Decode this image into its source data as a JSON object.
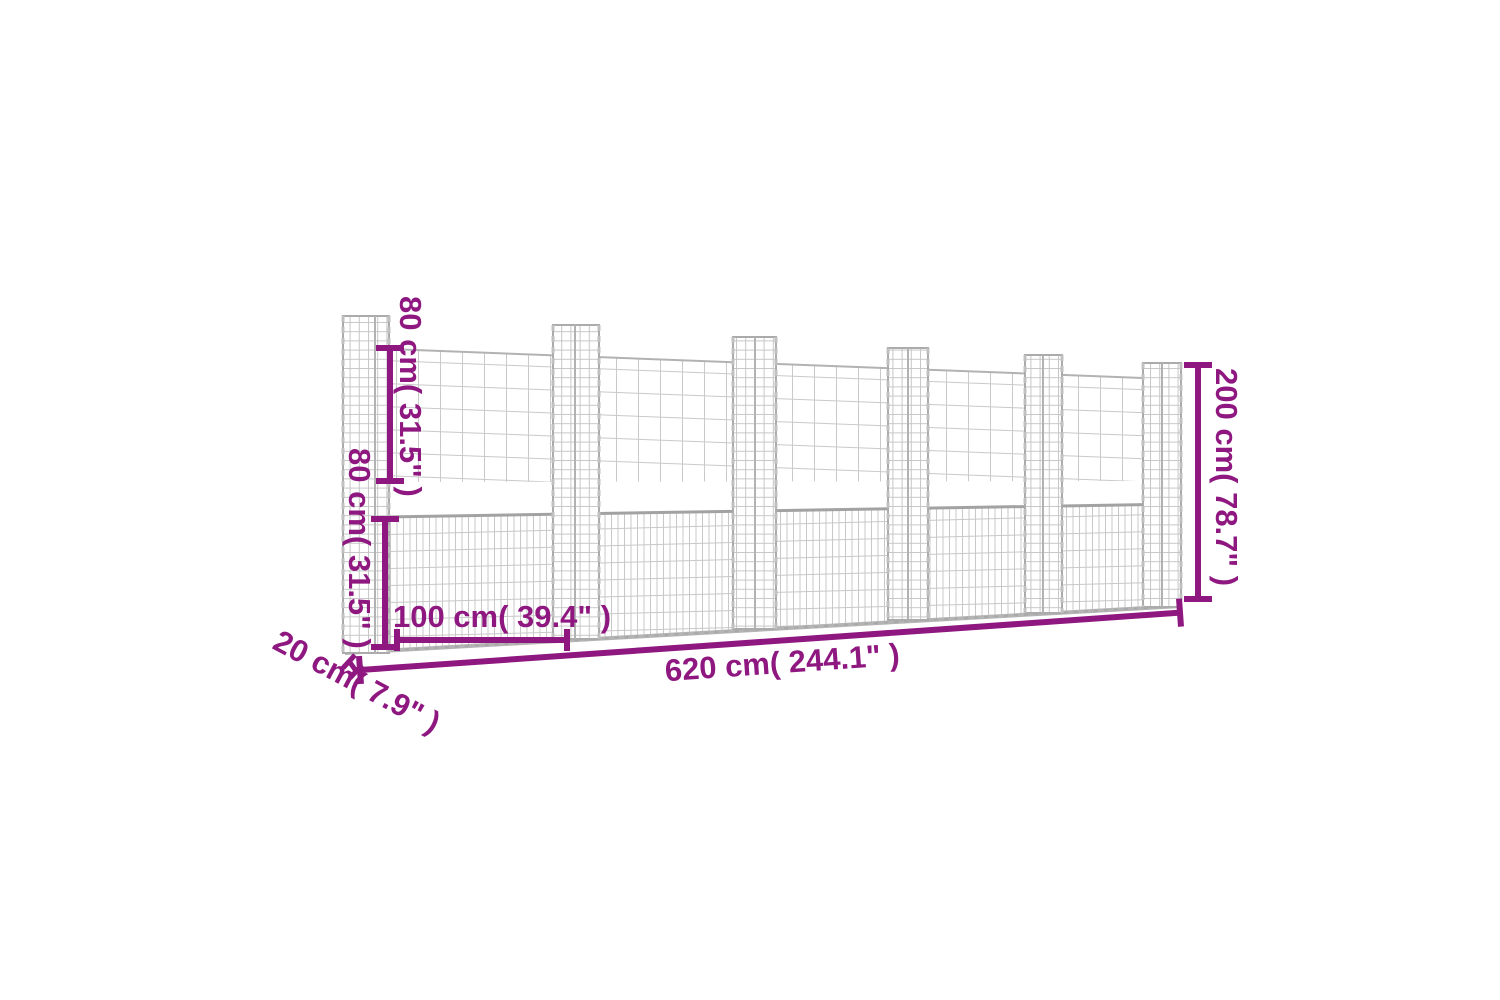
{
  "diagram": {
    "subject": "gabion-basket-wall-with-u-posts",
    "accent_color": "#8e1780",
    "mesh_line_color": "#c9c9c9",
    "frame_color": "#a2a2a2",
    "post_count": 6,
    "labels": {
      "upper_height": "80 cm( 31.5\" )",
      "lower_height": "80 cm( 31.5\" )",
      "post_spacing": "100 cm( 39.4\" )",
      "total_length": "620 cm( 244.1\" )",
      "total_height": "200 cm( 78.7\" )",
      "depth": "20 cm( 7.9\" )"
    }
  }
}
